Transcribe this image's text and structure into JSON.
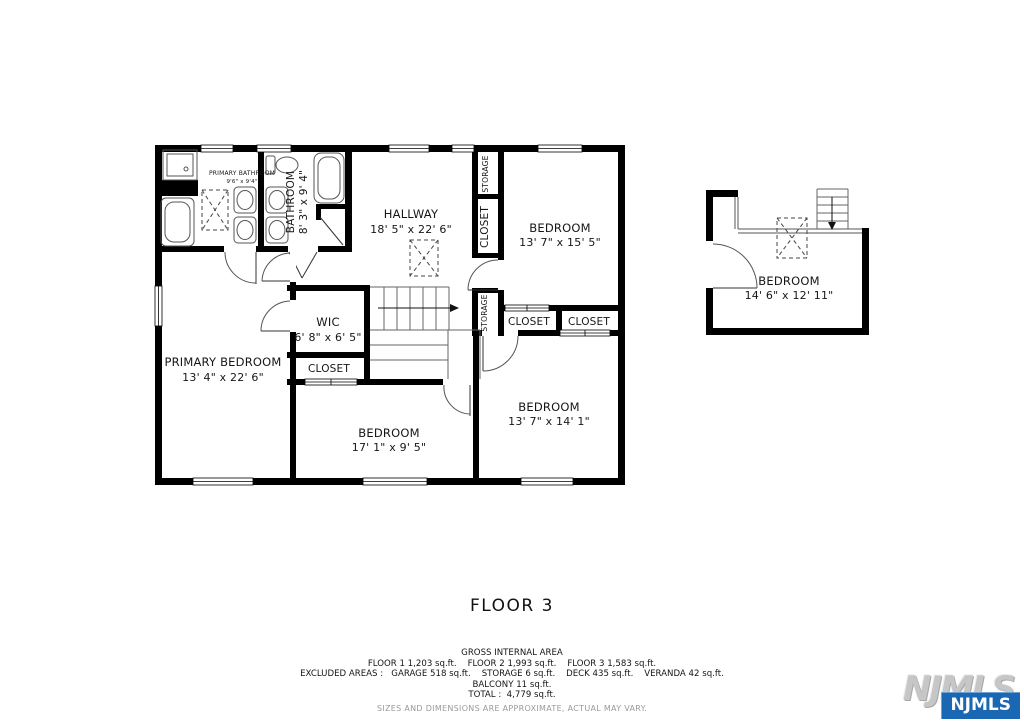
{
  "floor_title": "FLOOR 3",
  "rooms": {
    "primary_bathroom": {
      "name": "PRIMARY BATHROOM",
      "dims": "9'6\" x 9'4\""
    },
    "bathroom": {
      "name": "BATHROOM",
      "dims": "8' 3\" x 9' 4\""
    },
    "hallway": {
      "name": "HALLWAY",
      "dims": "18' 5\" x 22' 6\""
    },
    "bedroom_top_right": {
      "name": "BEDROOM",
      "dims": "13' 7\" x 15' 5\""
    },
    "wic": {
      "name": "WIC",
      "dims": "6' 8\" x 6' 5\""
    },
    "primary_bedroom": {
      "name": "PRIMARY BEDROOM",
      "dims": "13' 4\" x 22' 6\""
    },
    "bedroom_bottom_middle": {
      "name": "BEDROOM",
      "dims": "17' 1\" x 9' 5\""
    },
    "bedroom_bottom_right": {
      "name": "BEDROOM",
      "dims": "13' 7\" x 14' 1\""
    },
    "bedroom_detached": {
      "name": "BEDROOM",
      "dims": "14' 6\" x 12' 11\""
    }
  },
  "small_rooms": {
    "storage_top": "STORAGE",
    "closet_top": "CLOSET",
    "storage_mid": "STORAGE",
    "closet_row_1": "CLOSET",
    "closet_row_2": "CLOSET",
    "closet_wic": "CLOSET"
  },
  "footer": {
    "gross_title": "GROSS INTERNAL AREA",
    "floors_line": "FLOOR 1 1,203 sq.ft.    FLOOR 2 1,993 sq.ft.    FLOOR 3 1,583 sq.ft.",
    "excluded_line": "EXCLUDED AREAS :   GARAGE 518 sq.ft.    STORAGE 6 sq.ft.    DECK 435 sq.ft.    VERANDA 42 sq.ft.",
    "balcony_line": "BALCONY 11 sq.ft.",
    "total_line": "TOTAL :  4,779 sq.ft.",
    "disclaimer": "SIZES AND DIMENSIONS ARE APPROXIMATE, ACTUAL MAY VARY."
  },
  "watermark": {
    "back": "NJMLS",
    "front": "NJMLS"
  },
  "colors": {
    "wall": "#000000",
    "accent_blue": "#1a67b3",
    "muted_gray": "#9a9a9a"
  }
}
